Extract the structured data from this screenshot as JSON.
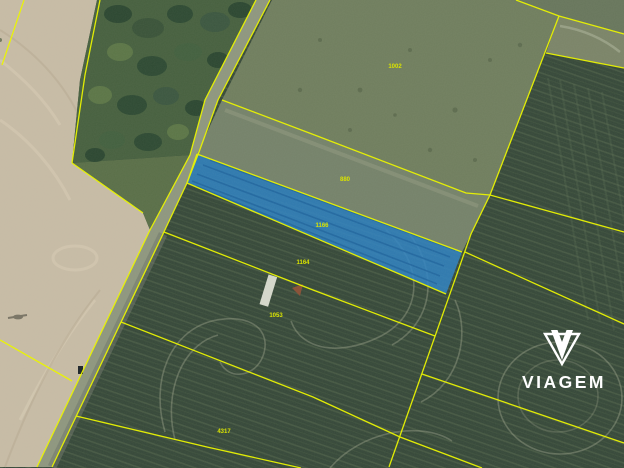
{
  "map": {
    "description": "aerial-cadastral-parcel-map",
    "boundary_color": "#eaf402",
    "highlight_color": "#2e83c4",
    "label_color": "#d9e300",
    "parcel_labels": [
      {
        "label": "1002"
      },
      {
        "label": "880"
      },
      {
        "label": "1166",
        "highlighted": true
      },
      {
        "label": "1164"
      },
      {
        "label": "1053"
      },
      {
        "label": "4317"
      }
    ]
  },
  "watermark": {
    "brand": "VIAGEM",
    "icon": "viagem-gem-icon",
    "color": "#ffffff"
  }
}
